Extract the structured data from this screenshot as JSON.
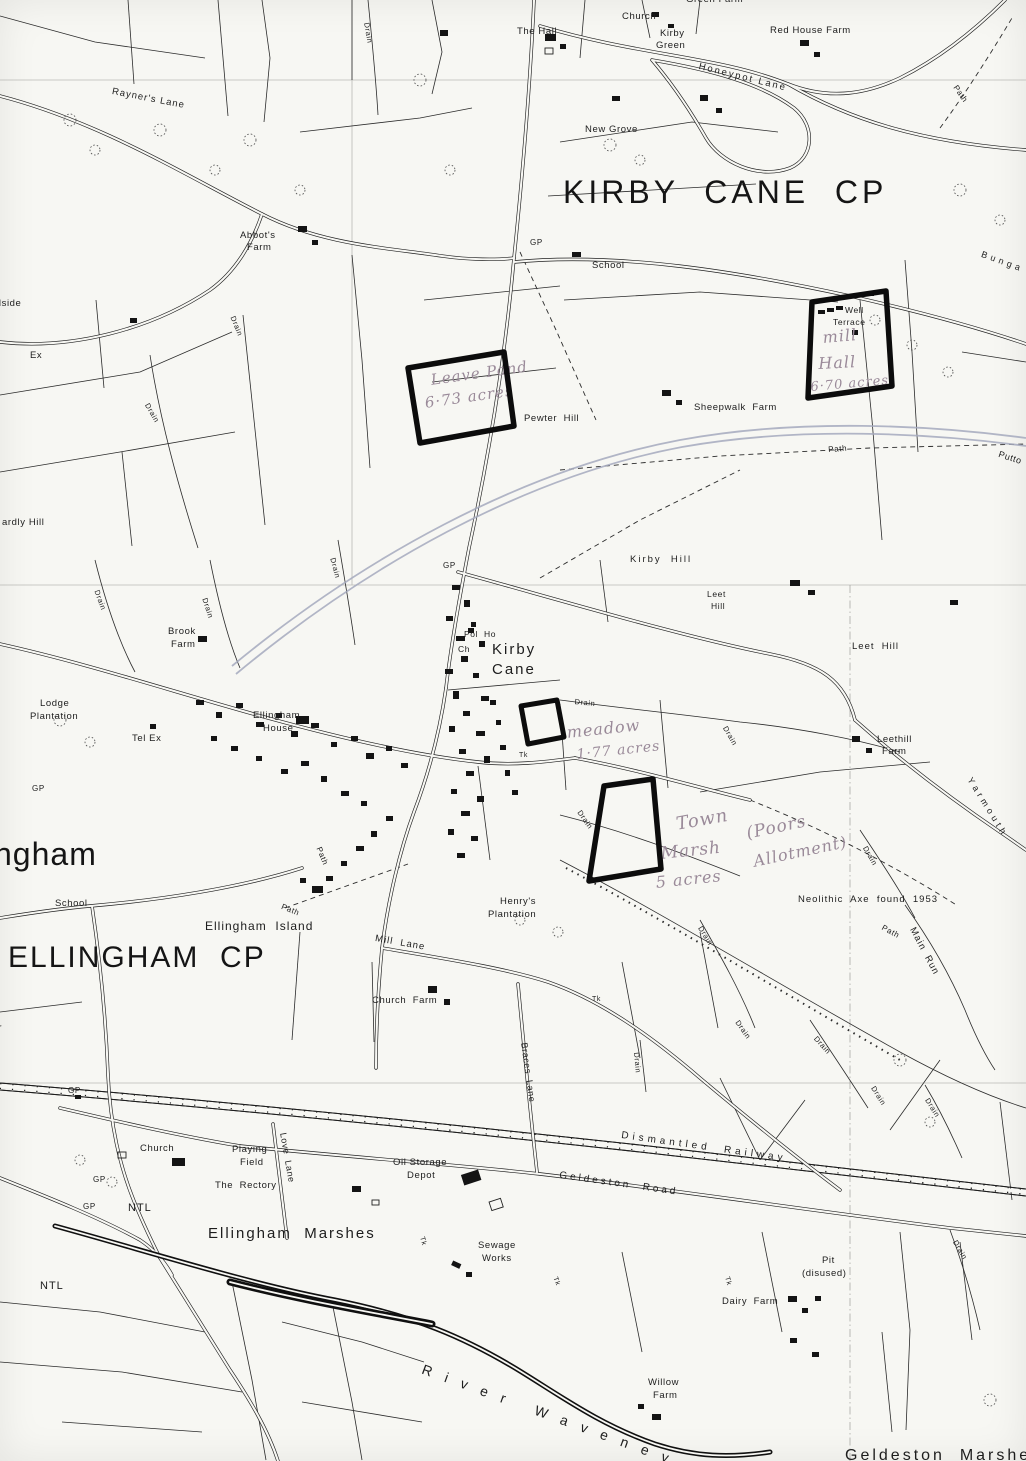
{
  "map": {
    "type": "scanned-ordnance-survey-parish-map",
    "colors": {
      "paper": "#f7f7f3",
      "ink": "#1d1d1d",
      "pencil_line": "#a4a9bd",
      "handwriting": "#9a8a99",
      "plot_marker": "#0c0c0c"
    },
    "parishes": [
      "KIRBY CANE CP",
      "ELLINGHAM CP"
    ],
    "plots": [
      {
        "name": "leave-pond-plot",
        "points": "408,368 504,352 514,426 420,443"
      },
      {
        "name": "mill-hall-plot",
        "points": "812,302 886,291 892,386 808,398"
      },
      {
        "name": "meadow-plot",
        "points": "521,706 557,700 564,737 528,744"
      },
      {
        "name": "town-marsh-plot",
        "points": "604,786 653,779 661,869 589,881"
      }
    ],
    "pencil": [
      "M232,666 C360,560 520,470 680,440 C800,418 930,425 1026,438",
      "M236,674 C365,567 522,477 682,447 C800,426 930,433 1026,446"
    ],
    "labels": [
      {
        "n": "label-kirby-cane-cp",
        "t": "KIRBY  CANE  CP",
        "x": 563,
        "y": 176,
        "s": 32,
        "ls": 4,
        "c": "big"
      },
      {
        "n": "label-ellingham-cp",
        "t": "ELLINGHAM  CP",
        "x": 8,
        "y": 942,
        "s": 30,
        "ls": 2,
        "c": "big"
      },
      {
        "n": "label-ellingham-partial",
        "t": "ngham",
        "x": -6,
        "y": 838,
        "s": 32,
        "ls": 1,
        "c": "big"
      },
      {
        "n": "label-geldeston-marshes-partial",
        "t": "Geldeston  Marshes",
        "x": 845,
        "y": 1448,
        "s": 16,
        "ls": 3
      },
      {
        "n": "label-kirby-cane-village",
        "t": "Kirby",
        "x": 492,
        "y": 642,
        "s": 15,
        "ls": 2
      },
      {
        "n": "label-kirby-cane-village",
        "t": "Cane",
        "x": 492,
        "y": 662,
        "s": 15,
        "ls": 2
      },
      {
        "n": "label-ellingham-marshes",
        "t": "Ellingham  Marshes",
        "x": 208,
        "y": 1226,
        "s": 15,
        "ls": 2
      },
      {
        "n": "label-ellingham-island",
        "t": "Ellingham  Island",
        "x": 205,
        "y": 920,
        "s": 12,
        "ls": 1
      },
      {
        "n": "label-church-top",
        "t": "Church",
        "x": 622,
        "y": 12
      },
      {
        "n": "label-green-farm",
        "t": "Green Farm",
        "x": 686,
        "y": -5
      },
      {
        "n": "label-the-hall",
        "t": "The Hall",
        "x": 517,
        "y": 27
      },
      {
        "n": "label-kirby-green",
        "t": "Kirby",
        "x": 660,
        "y": 29
      },
      {
        "n": "label-kirby-green",
        "t": "Green",
        "x": 656,
        "y": 41
      },
      {
        "n": "label-red-house-farm",
        "t": "Red House Farm",
        "x": 770,
        "y": 26
      },
      {
        "n": "label-honeypot-lane",
        "t": "Honeypot Lane",
        "x": 700,
        "y": 62,
        "r": 14,
        "ls": 2
      },
      {
        "n": "label-new-grove",
        "t": "New Grove",
        "x": 585,
        "y": 125
      },
      {
        "n": "label-rayners-lane",
        "t": "Rayner's Lane",
        "x": 113,
        "y": 87,
        "r": 11,
        "ls": 1
      },
      {
        "n": "label-abbots-farm",
        "t": "Abbot's",
        "x": 240,
        "y": 231
      },
      {
        "n": "label-abbots-farm",
        "t": "Farm",
        "x": 247,
        "y": 243
      },
      {
        "n": "label-gp",
        "t": "GP",
        "x": 530,
        "y": 239,
        "s": 8
      },
      {
        "n": "label-school-top",
        "t": "School",
        "x": 592,
        "y": 261
      },
      {
        "n": "label-bungay-partial",
        "t": "B u n g a",
        "x": 983,
        "y": 250,
        "r": 20,
        "s": 9
      },
      {
        "n": "label-hillside-partial",
        "t": "Hillside",
        "x": -14,
        "y": 299
      },
      {
        "n": "label-ex-partial",
        "t": "Ex",
        "x": 30,
        "y": 351
      },
      {
        "n": "label-well-terrace",
        "t": "Well",
        "x": 845,
        "y": 306,
        "s": 8.5
      },
      {
        "n": "label-well-terrace",
        "t": "Terrace",
        "x": 833,
        "y": 318,
        "s": 8.5
      },
      {
        "n": "label-sheepwalk-farm",
        "t": "Sheepwalk  Farm",
        "x": 694,
        "y": 403
      },
      {
        "n": "label-pewter-hill",
        "t": "Pewter  Hill",
        "x": 524,
        "y": 414
      },
      {
        "n": "label-path",
        "t": "Path",
        "x": 828,
        "y": 446,
        "r": -4,
        "s": 8
      },
      {
        "n": "label-puttock-partial",
        "t": "Putto",
        "x": 1000,
        "y": 450,
        "r": 18,
        "s": 9
      },
      {
        "n": "label-path",
        "t": "Path",
        "x": 958,
        "y": 84,
        "r": 55,
        "s": 8
      },
      {
        "n": "label-ardly-hill-partial",
        "t": "ardly Hill",
        "x": 2,
        "y": 518
      },
      {
        "n": "label-kirby-hill",
        "t": "Kirby  Hill",
        "x": 630,
        "y": 555,
        "ls": 2
      },
      {
        "n": "label-leet-hill",
        "t": "Leet",
        "x": 707,
        "y": 590,
        "s": 8.5
      },
      {
        "n": "label-leet-hill",
        "t": "Hill",
        "x": 711,
        "y": 602,
        "s": 8.5
      },
      {
        "n": "label-leet-hill-east",
        "t": "Leet  Hill",
        "x": 852,
        "y": 642,
        "ls": 1
      },
      {
        "n": "label-gp",
        "t": "GP",
        "x": 443,
        "y": 562,
        "s": 8
      },
      {
        "n": "label-pol-ho",
        "t": "Pol  Ho",
        "x": 464,
        "y": 630,
        "s": 8.5
      },
      {
        "n": "label-ch",
        "t": "Ch",
        "x": 458,
        "y": 645,
        "s": 8.5
      },
      {
        "n": "label-brook-farm",
        "t": "Brook",
        "x": 168,
        "y": 627
      },
      {
        "n": "label-brook-farm",
        "t": "Farm",
        "x": 171,
        "y": 640
      },
      {
        "n": "label-lodge-plantation",
        "t": "Lodge",
        "x": 40,
        "y": 699
      },
      {
        "n": "label-lodge-plantation",
        "t": "Plantation",
        "x": 30,
        "y": 712
      },
      {
        "n": "label-tel-ex",
        "t": "Tel Ex",
        "x": 132,
        "y": 734
      },
      {
        "n": "label-gp",
        "t": "GP",
        "x": 32,
        "y": 785,
        "s": 8
      },
      {
        "n": "label-ellingham-house",
        "t": "Ellingham",
        "x": 253,
        "y": 711
      },
      {
        "n": "label-ellingham-house",
        "t": "House",
        "x": 263,
        "y": 724
      },
      {
        "n": "label-leethill-farm",
        "t": "Leethill",
        "x": 877,
        "y": 735
      },
      {
        "n": "label-leethill-farm",
        "t": "Farm",
        "x": 882,
        "y": 747
      },
      {
        "n": "label-yarmouth-road",
        "t": "Y a r m o u t h",
        "x": 973,
        "y": 776,
        "r": 58,
        "s": 9
      },
      {
        "n": "label-school-left",
        "t": "School",
        "x": 55,
        "y": 899
      },
      {
        "n": "label-henrys-plantation",
        "t": "Henry's",
        "x": 500,
        "y": 897
      },
      {
        "n": "label-henrys-plantation",
        "t": "Plantation",
        "x": 488,
        "y": 910
      },
      {
        "n": "label-mill-lane",
        "t": "Mill  Lane",
        "x": 376,
        "y": 934,
        "r": 10,
        "ls": 1
      },
      {
        "n": "label-neolithic-axe",
        "t": "Neolithic  Axe  found  1953",
        "x": 798,
        "y": 895,
        "ls": 1
      },
      {
        "n": "label-main-run",
        "t": "Main  Run",
        "x": 916,
        "y": 926,
        "r": 62,
        "ls": 1
      },
      {
        "n": "label-church-farm",
        "t": "Church  Farm",
        "x": 372,
        "y": 996
      },
      {
        "n": "label-path",
        "t": "Path",
        "x": 283,
        "y": 903,
        "r": 22,
        "s": 8
      },
      {
        "n": "label-path",
        "t": "Path",
        "x": 322,
        "y": 846,
        "r": 68,
        "s": 8
      },
      {
        "n": "label-path",
        "t": "Path",
        "x": 884,
        "y": 924,
        "r": 28,
        "s": 8
      },
      {
        "n": "label-road-partial",
        "t": "Road",
        "x": -2,
        "y": 1006,
        "r": 80,
        "s": 8
      },
      {
        "n": "label-braces-lane",
        "t": "Braces  Lane",
        "x": 528,
        "y": 1042,
        "r": 82,
        "s": 9
      },
      {
        "n": "label-dismantled-railway",
        "t": "Dismantled  Railway",
        "x": 622,
        "y": 1131,
        "r": 8,
        "ls": 4,
        "s": 10
      },
      {
        "n": "label-geldeston-road",
        "t": "Geldeston  Road",
        "x": 560,
        "y": 1171,
        "r": 8,
        "ls": 3,
        "s": 10
      },
      {
        "n": "label-oil-storage-depot",
        "t": "Oil Storage",
        "x": 393,
        "y": 1158
      },
      {
        "n": "label-oil-storage-depot",
        "t": "Depot",
        "x": 407,
        "y": 1171
      },
      {
        "n": "label-gp",
        "t": "GP",
        "x": 68,
        "y": 1087,
        "s": 8
      },
      {
        "n": "label-gp",
        "t": "GP",
        "x": 93,
        "y": 1176,
        "s": 8
      },
      {
        "n": "label-gp",
        "t": "GP",
        "x": 83,
        "y": 1203,
        "s": 8
      },
      {
        "n": "label-church-bottom",
        "t": "Church",
        "x": 140,
        "y": 1144
      },
      {
        "n": "label-playing-field",
        "t": "Playing",
        "x": 232,
        "y": 1145
      },
      {
        "n": "label-playing-field",
        "t": "Field",
        "x": 240,
        "y": 1158
      },
      {
        "n": "label-the-rectory",
        "t": "The  Rectory",
        "x": 215,
        "y": 1181
      },
      {
        "n": "label-love-lane",
        "t": "Love  Lane",
        "x": 287,
        "y": 1132,
        "r": 80,
        "s": 9
      },
      {
        "n": "label-ntl",
        "t": "NTL",
        "x": 128,
        "y": 1203,
        "s": 11,
        "ls": 1
      },
      {
        "n": "label-ntl",
        "t": "NTL",
        "x": 40,
        "y": 1281,
        "s": 11,
        "ls": 1
      },
      {
        "n": "label-sewage-works",
        "t": "Sewage",
        "x": 478,
        "y": 1241
      },
      {
        "n": "label-sewage-works",
        "t": "Works",
        "x": 482,
        "y": 1254
      },
      {
        "n": "label-dairy-farm",
        "t": "Dairy  Farm",
        "x": 722,
        "y": 1297
      },
      {
        "n": "label-pit-disused",
        "t": "Pit",
        "x": 822,
        "y": 1256
      },
      {
        "n": "label-pit-disused",
        "t": "(disused)",
        "x": 802,
        "y": 1269
      },
      {
        "n": "label-willow-farm",
        "t": "Willow",
        "x": 648,
        "y": 1378
      },
      {
        "n": "label-willow-farm",
        "t": "Farm",
        "x": 653,
        "y": 1391
      },
      {
        "n": "label-river-waveney",
        "t": "R i v e r   W a v e n e y",
        "x": 425,
        "y": 1362,
        "r": 20,
        "s": 14,
        "ls": 5
      },
      {
        "n": "label-tk",
        "t": "Tk",
        "x": 519,
        "y": 752,
        "s": 7
      },
      {
        "n": "label-tk",
        "t": "Tk",
        "x": 592,
        "y": 996,
        "s": 7
      },
      {
        "n": "label-tk",
        "t": "Tk",
        "x": 425,
        "y": 1236,
        "r": 75,
        "s": 7
      },
      {
        "n": "label-tk",
        "t": "Tk",
        "x": 558,
        "y": 1276,
        "r": 70,
        "s": 7
      },
      {
        "n": "label-tk",
        "t": "Tk",
        "x": 730,
        "y": 1276,
        "r": 75,
        "s": 7
      },
      {
        "n": "label-drain",
        "t": "Drain",
        "x": 370,
        "y": 22,
        "r": 80,
        "s": 7.5
      },
      {
        "n": "label-drain",
        "t": "Drain",
        "x": 150,
        "y": 402,
        "r": 60,
        "s": 7.5
      },
      {
        "n": "label-drain",
        "t": "Drain",
        "x": 236,
        "y": 315,
        "r": 68,
        "s": 7.5
      },
      {
        "n": "label-drain",
        "t": "Drain",
        "x": 100,
        "y": 589,
        "r": 70,
        "s": 7.5
      },
      {
        "n": "label-drain",
        "t": "Drain",
        "x": 208,
        "y": 597,
        "r": 72,
        "s": 7.5
      },
      {
        "n": "label-drain",
        "t": "Drain",
        "x": 336,
        "y": 557,
        "r": 75,
        "s": 7.5
      },
      {
        "n": "label-drain",
        "t": "Drain",
        "x": 575,
        "y": 698,
        "r": 6,
        "s": 7.5
      },
      {
        "n": "label-drain",
        "t": "Drain",
        "x": 728,
        "y": 725,
        "r": 60,
        "s": 7.5
      },
      {
        "n": "label-drain",
        "t": "Drain",
        "x": 582,
        "y": 809,
        "r": 55,
        "s": 7.5
      },
      {
        "n": "label-drain",
        "t": "Drain",
        "x": 868,
        "y": 845,
        "r": 60,
        "s": 7.5
      },
      {
        "n": "label-drain",
        "t": "Drain",
        "x": 703,
        "y": 925,
        "r": 58,
        "s": 7.5
      },
      {
        "n": "label-drain",
        "t": "Drain",
        "x": 740,
        "y": 1019,
        "r": 55,
        "s": 7.5
      },
      {
        "n": "label-drain",
        "t": "Drain",
        "x": 818,
        "y": 1035,
        "r": 48,
        "s": 7.5
      },
      {
        "n": "label-drain",
        "t": "Drain",
        "x": 876,
        "y": 1085,
        "r": 58,
        "s": 7.5
      },
      {
        "n": "label-drain",
        "t": "Drain",
        "x": 930,
        "y": 1097,
        "r": 58,
        "s": 7.5
      },
      {
        "n": "label-drain",
        "t": "Drain",
        "x": 640,
        "y": 1052,
        "r": 85,
        "s": 7.5
      },
      {
        "n": "label-drain",
        "t": "Drain",
        "x": 958,
        "y": 1239,
        "r": 60,
        "s": 7.5
      },
      {
        "n": "label-leave-pond-note",
        "t": "Leave Pond",
        "x": 430,
        "y": 373,
        "r": -8,
        "s": 15,
        "c": "hand"
      },
      {
        "n": "label-leave-pond-note",
        "t": "6·73 acres",
        "x": 424,
        "y": 396,
        "r": -8,
        "s": 15,
        "c": "hand"
      },
      {
        "n": "label-mill-hall-note",
        "t": "mill",
        "x": 822,
        "y": 330,
        "r": -5,
        "s": 16,
        "c": "hand"
      },
      {
        "n": "label-mill-hall-note",
        "t": "Hall",
        "x": 818,
        "y": 356,
        "r": -3,
        "s": 16,
        "c": "hand"
      },
      {
        "n": "label-mill-hall-note",
        "t": "6·70 acres",
        "x": 810,
        "y": 381,
        "r": -5,
        "s": 13,
        "c": "hand"
      },
      {
        "n": "label-meadow-note",
        "t": "meadow",
        "x": 566,
        "y": 725,
        "r": -6,
        "s": 16,
        "c": "hand"
      },
      {
        "n": "label-meadow-note",
        "t": "1·77 acres",
        "x": 576,
        "y": 748,
        "r": -6,
        "s": 14,
        "c": "hand"
      },
      {
        "n": "label-town-marsh-note",
        "t": "Town",
        "x": 675,
        "y": 816,
        "r": -10,
        "s": 18,
        "c": "hand"
      },
      {
        "n": "label-town-marsh-note",
        "t": "Marsh",
        "x": 660,
        "y": 846,
        "r": -6,
        "s": 17,
        "c": "hand"
      },
      {
        "n": "label-town-marsh-note",
        "t": "5 acres",
        "x": 655,
        "y": 875,
        "r": -6,
        "s": 16,
        "c": "hand"
      },
      {
        "n": "label-poors-allotment-note",
        "t": "(Poors",
        "x": 745,
        "y": 826,
        "r": -12,
        "s": 17,
        "c": "hand"
      },
      {
        "n": "label-poors-allotment-note",
        "t": "Allotment)",
        "x": 752,
        "y": 854,
        "r": -12,
        "s": 16,
        "c": "hand"
      }
    ]
  }
}
